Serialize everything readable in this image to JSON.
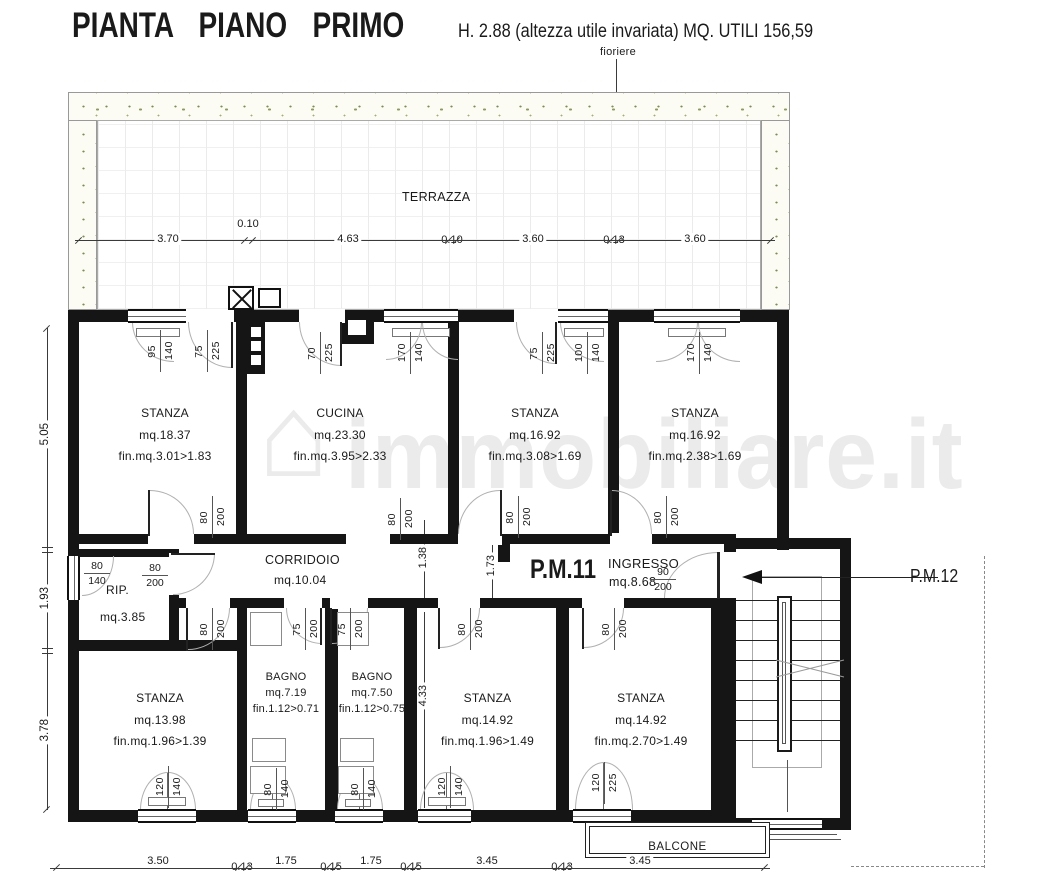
{
  "header": {
    "title": "PIANTA PIANO PRIMO",
    "subtitle": "H. 2.88  (altezza utile invariata)  MQ. UTILI 156,59"
  },
  "annotations": {
    "fioriere": "fioriere",
    "terrazza": "TERRAZZA",
    "balcone": "BALCONE",
    "corridoio": "CORRIDOIO",
    "corridoio_mq": "mq.10.04",
    "rip": "RIP.",
    "rip_mq": "mq.3.85",
    "pm11": "P.M.11",
    "ingresso": "INGRESSO",
    "ingresso_mq": "mq.8.68",
    "pm12": "P.M.12",
    "watermark": "immobiliare.it"
  },
  "rooms": [
    {
      "name": "STANZA",
      "mq": "mq.18.37",
      "fin": "fin.mq.3.01>1.83"
    },
    {
      "name": "CUCINA",
      "mq": "mq.23.30",
      "fin": "fin.mq.3.95>2.33"
    },
    {
      "name": "STANZA",
      "mq": "mq.16.92",
      "fin": "fin.mq.3.08>1.69"
    },
    {
      "name": "STANZA",
      "mq": "mq.16.92",
      "fin": "fin.mq.2.38>1.69"
    },
    {
      "name": "STANZA",
      "mq": "mq.13.98",
      "fin": "fin.mq.1.96>1.39"
    },
    {
      "name": "BAGNO",
      "mq": "mq.7.19",
      "fin": "fin.1.12>0.71"
    },
    {
      "name": "BAGNO",
      "mq": "mq.7.50",
      "fin": "fin.1.12>0.75"
    },
    {
      "name": "STANZA",
      "mq": "mq.14.92",
      "fin": "fin.mq.1.96>1.49"
    },
    {
      "name": "STANZA",
      "mq": "mq.14.92",
      "fin": "fin.mq.2.70>1.49"
    }
  ],
  "dims": {
    "terrace": [
      "3.70",
      "0.10",
      "4.63",
      "0.10",
      "3.60",
      "0.13",
      "3.60"
    ],
    "bottom": [
      "3.50",
      "0.13",
      "1.75",
      "0.15",
      "1.75",
      "0.15",
      "3.45",
      "0.13",
      "3.45"
    ],
    "left": [
      "5.05",
      "1.93",
      "3.78"
    ],
    "interior": [
      "1.38",
      "1.73",
      "4.33"
    ]
  },
  "openings": {
    "top": [
      [
        "95",
        "140"
      ],
      [
        "75",
        "225"
      ],
      [
        "70",
        "225"
      ],
      [
        "170",
        "140"
      ],
      [
        "75",
        "225"
      ],
      [
        "100",
        "140"
      ],
      [
        "170",
        "140"
      ]
    ],
    "upper_doors": [
      [
        "80",
        "200"
      ],
      [
        "80",
        "200"
      ],
      [
        "80",
        "200"
      ],
      [
        "80",
        "200"
      ]
    ],
    "lower_doors": [
      [
        "80",
        "200"
      ],
      [
        "75",
        "200"
      ],
      [
        "75",
        "200"
      ],
      [
        "80",
        "200"
      ],
      [
        "80",
        "200"
      ]
    ],
    "bottom": [
      [
        "120",
        "140"
      ],
      [
        "80",
        "140"
      ],
      [
        "80",
        "140"
      ],
      [
        "120",
        "140"
      ],
      [
        "120",
        "225"
      ]
    ],
    "rip_window": [
      "80",
      "140"
    ],
    "rip_door": [
      "80",
      "200"
    ],
    "entry": [
      "90",
      "200"
    ]
  }
}
